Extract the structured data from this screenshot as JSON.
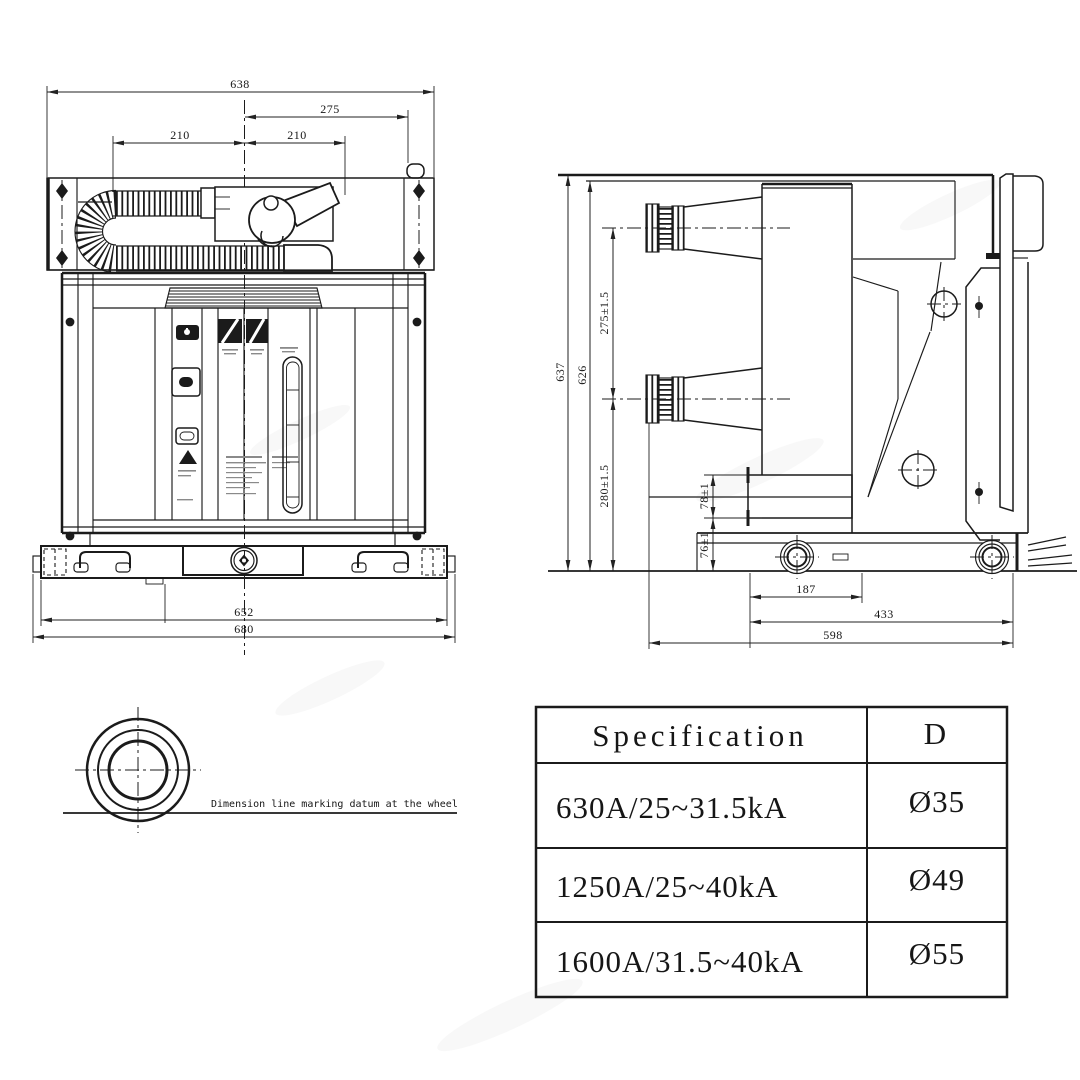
{
  "page": {
    "background": "#ffffff",
    "line_color": "#1b1b1b"
  },
  "front_view": {
    "dims": {
      "width_638": "638",
      "offset_275": "275",
      "left_210": "210",
      "right_210": "210",
      "base_652": "652",
      "base_680": "680"
    }
  },
  "side_view": {
    "dims": {
      "height_637": "637",
      "height_626": "626",
      "pole_gap_275": "275±1.5",
      "lower_280": "280±1.5",
      "upper_78": "78±1",
      "lower_76": "76±1",
      "wheel_187": "187",
      "depth_433": "433",
      "depth_598": "598"
    }
  },
  "wheel_detail": {
    "note": "Dimension line marking datum at the wheel"
  },
  "spec_table": {
    "headers": [
      "Specification",
      "D"
    ],
    "rows": [
      {
        "spec": "630A/25~31.5kA",
        "d": "Ø35"
      },
      {
        "spec": "1250A/25~40kA",
        "d": "Ø49"
      },
      {
        "spec": "1600A/31.5~40kA",
        "d": "Ø55"
      }
    ]
  }
}
